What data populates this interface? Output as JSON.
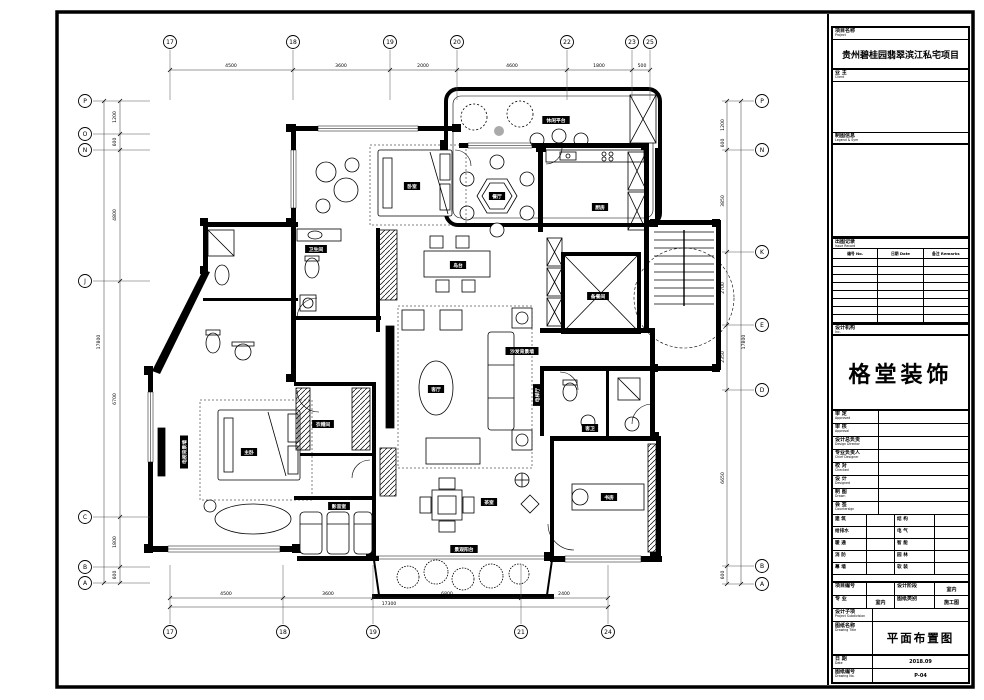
{
  "sheet": {
    "project_label": "项目名称",
    "project_label_en": "Project",
    "project_name": "贵州碧桂园翡翠滨江私宅项目",
    "client_label": "业 主",
    "client_label_en": "Client",
    "legend_label": "制图信息",
    "legend_label_en": "Legend & Sym",
    "issue_label": "出图记录",
    "issue_label_en": "Issue Record",
    "issue_cols": [
      "编号 No.",
      "日期 Date",
      "备注 Remarks"
    ],
    "firm_label": "设计机构",
    "firm_label_en": "Inc.",
    "logo": "格堂装饰",
    "fields": [
      {
        "cn": "审 定",
        "en": "Approved"
      },
      {
        "cn": "审 核",
        "en": "Approval"
      },
      {
        "cn": "设计总负责",
        "en": "Design Director"
      },
      {
        "cn": "专业负责人",
        "en": "Chief Designer"
      },
      {
        "cn": "校 对",
        "en": "Checked"
      },
      {
        "cn": "设 计",
        "en": "Designed"
      },
      {
        "cn": "制 图",
        "en": "Drawn"
      },
      {
        "cn": "会 签",
        "en": "Countersign"
      }
    ],
    "signs": [
      [
        "建 筑",
        "结 构"
      ],
      [
        "给排水",
        "电 气"
      ],
      [
        "暖 通",
        "智 能"
      ],
      [
        "消 防",
        "园 林"
      ],
      [
        "幕 墙",
        "软 装"
      ]
    ],
    "project_no_label": "项目编号",
    "project_no_value": "",
    "stage_label": "设计阶段",
    "stage_value": "室内",
    "major_label": "专 业",
    "major_value": "室内",
    "type_label": "图纸类别",
    "type_value": "施工图",
    "subitem_label": "设计子项",
    "subitem_label_en": "Project Subdivision",
    "title_label": "图纸名称",
    "title_label_en": "Drawing Title",
    "drawing_title": "平面布置图",
    "date_label": "日 期",
    "date_label_en": "Date",
    "date_value": "2018.09",
    "no_label": "图纸编号",
    "no_label_en": "Drawing No.",
    "no_value": "P-04"
  },
  "plan": {
    "top_axes": [
      {
        "n": "17",
        "x": 170
      },
      {
        "n": "18",
        "x": 293
      },
      {
        "n": "19",
        "x": 390
      },
      {
        "n": "20",
        "x": 457
      },
      {
        "n": "22",
        "x": 567
      },
      {
        "n": "23",
        "x": 632
      },
      {
        "n": "25",
        "x": 650
      }
    ],
    "bottom_axes": [
      {
        "n": "17",
        "x": 170
      },
      {
        "n": "18",
        "x": 283
      },
      {
        "n": "19",
        "x": 373
      },
      {
        "n": "21",
        "x": 521
      },
      {
        "n": "24",
        "x": 608
      }
    ],
    "left_axes": [
      {
        "n": "P",
        "y": 101
      },
      {
        "n": "O",
        "y": 134
      },
      {
        "n": "N",
        "y": 150
      },
      {
        "n": "J",
        "y": 281
      },
      {
        "n": "C",
        "y": 517
      },
      {
        "n": "B",
        "y": 567
      },
      {
        "n": "A",
        "y": 583
      }
    ],
    "right_axes": [
      {
        "n": "P",
        "y": 101
      },
      {
        "n": "N",
        "y": 150
      },
      {
        "n": "K",
        "y": 252
      },
      {
        "n": "E",
        "y": 325
      },
      {
        "n": "D",
        "y": 390
      },
      {
        "n": "B",
        "y": 566
      },
      {
        "n": "A",
        "y": 584
      }
    ],
    "top_dims": [
      {
        "t": "4500",
        "x": 231
      },
      {
        "t": "3600",
        "x": 341
      },
      {
        "t": "2000",
        "x": 423
      },
      {
        "t": "4600",
        "x": 512
      },
      {
        "t": "1800",
        "x": 599
      },
      {
        "t": "500",
        "x": 642
      }
    ],
    "bottom_dims": [
      {
        "t": "4500",
        "x": 226
      },
      {
        "t": "3600",
        "x": 328
      },
      {
        "t": "6800",
        "x": 447
      },
      {
        "t": "2400",
        "x": 564
      }
    ],
    "bottom_total": {
      "t": "17300",
      "x": 389
    },
    "left_dims": [
      {
        "t": "1200",
        "y": 117
      },
      {
        "t": "600",
        "y": 142
      },
      {
        "t": "4800",
        "y": 215
      },
      {
        "t": "6700",
        "y": 399
      },
      {
        "t": "1800",
        "y": 542
      },
      {
        "t": "600",
        "y": 575
      }
    ],
    "left_total": {
      "t": "17800",
      "y": 342
    },
    "right_dims": [
      {
        "t": "1200",
        "y": 125
      },
      {
        "t": "600",
        "y": 143
      },
      {
        "t": "3850",
        "y": 201
      },
      {
        "t": "2700",
        "y": 288
      },
      {
        "t": "2350",
        "y": 357
      },
      {
        "t": "6650",
        "y": 478
      },
      {
        "t": "600",
        "y": 575
      }
    ],
    "right_total": {
      "t": "17800",
      "y": 342
    },
    "room_labels": [
      {
        "t": "餐厅",
        "x": 497,
        "y": 196
      },
      {
        "t": "卧室",
        "x": 412,
        "y": 186
      },
      {
        "t": "卫生间",
        "x": 316,
        "y": 249
      },
      {
        "t": "岛台",
        "x": 458,
        "y": 265
      },
      {
        "t": "厨房",
        "x": 600,
        "y": 207
      },
      {
        "t": "备餐间",
        "x": 598,
        "y": 296
      },
      {
        "t": "客厅",
        "x": 436,
        "y": 389
      },
      {
        "t": "沙发背景墙",
        "x": 522,
        "y": 351
      },
      {
        "t": "电梯厅",
        "x": 537,
        "y": 395,
        "v": 1
      },
      {
        "t": "客卫",
        "x": 590,
        "y": 428
      },
      {
        "t": "主卧",
        "x": 249,
        "y": 452
      },
      {
        "t": "衣帽间",
        "x": 323,
        "y": 424
      },
      {
        "t": "影音室",
        "x": 339,
        "y": 506
      },
      {
        "t": "茶室",
        "x": 489,
        "y": 502
      },
      {
        "t": "景观阳台",
        "x": 464,
        "y": 549
      },
      {
        "t": "书房",
        "x": 609,
        "y": 497
      },
      {
        "t": "休闲平台",
        "x": 556,
        "y": 120
      },
      {
        "t": "电视背景墙",
        "x": 184,
        "y": 452,
        "v": 1
      }
    ]
  }
}
